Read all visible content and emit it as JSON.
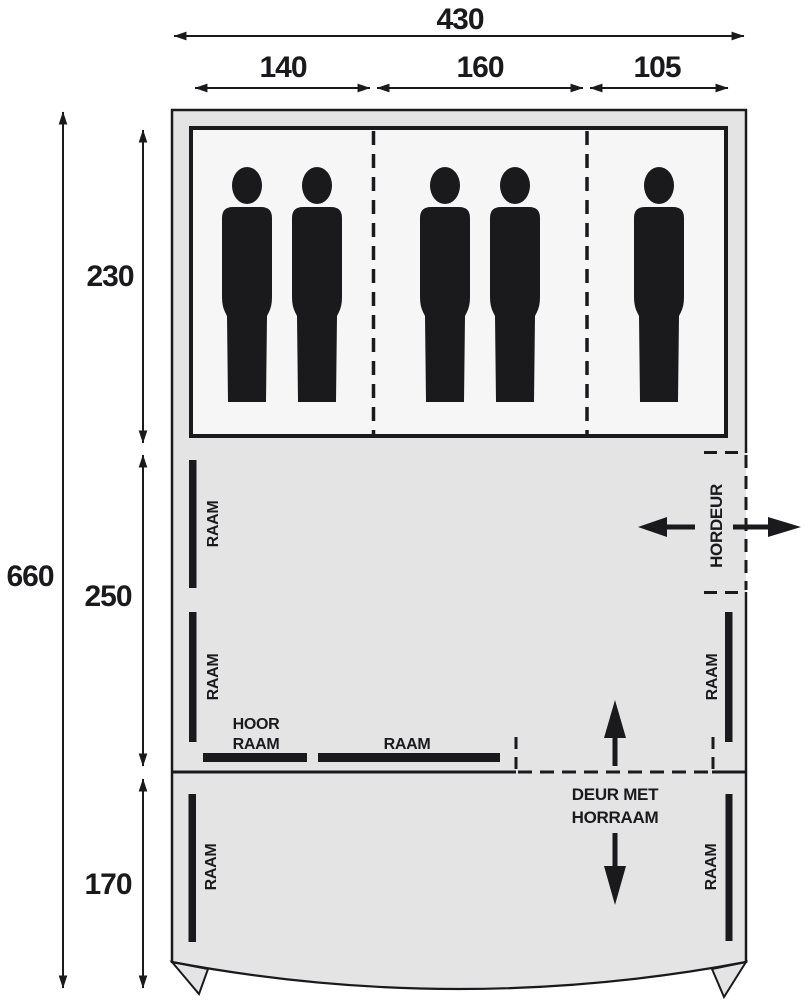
{
  "diagram": {
    "type": "tent-floorplan-top-view",
    "dimensions": {
      "total_width": "430",
      "width_sections": [
        "140",
        "160",
        "105"
      ],
      "total_depth": "660",
      "depth_sections": [
        "230",
        "250",
        "170"
      ]
    },
    "labels": {
      "window": "RAAM",
      "screen_window_line1": "HOOR",
      "screen_window_line2": "RAAM",
      "screen_door": "HORDEUR",
      "front_door_line1": "DEUR MET",
      "front_door_line2": "HORRAAM"
    },
    "occupants": {
      "section_140": 2,
      "section_160": 2,
      "section_105": 1,
      "total": 5
    },
    "colors": {
      "outline": "#1a1a1d",
      "tent_fill": "#e4e4e5",
      "bedroom_fill": "#f6f6f6",
      "background": "#ffffff"
    }
  }
}
